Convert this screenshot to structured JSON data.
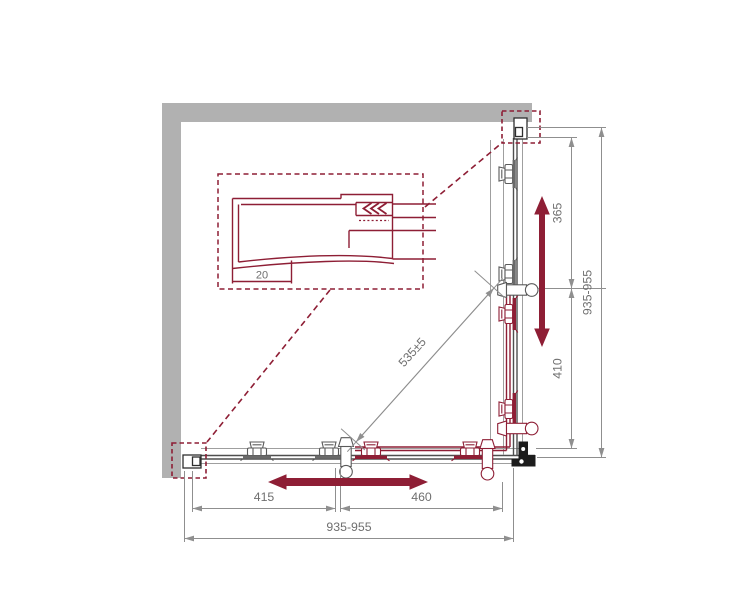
{
  "dimensions": {
    "right_upper": "365",
    "right_lower": "410",
    "right_overall": "935-955",
    "bottom_left_span": "415",
    "bottom_right_span": "460",
    "bottom_overall": "935-955",
    "diagonal": "535±5",
    "detail_wall_adjust": "20"
  },
  "colors": {
    "wall_gray": "#b1b1b1",
    "accent_red": "#8e1e35",
    "line_gray": "#9f9f9f",
    "dark_line": "#4f4f4f",
    "dim_gray": "#8f8f8f",
    "text_gray": "#6f6f6f",
    "bracket_black": "#1c1c1c"
  }
}
